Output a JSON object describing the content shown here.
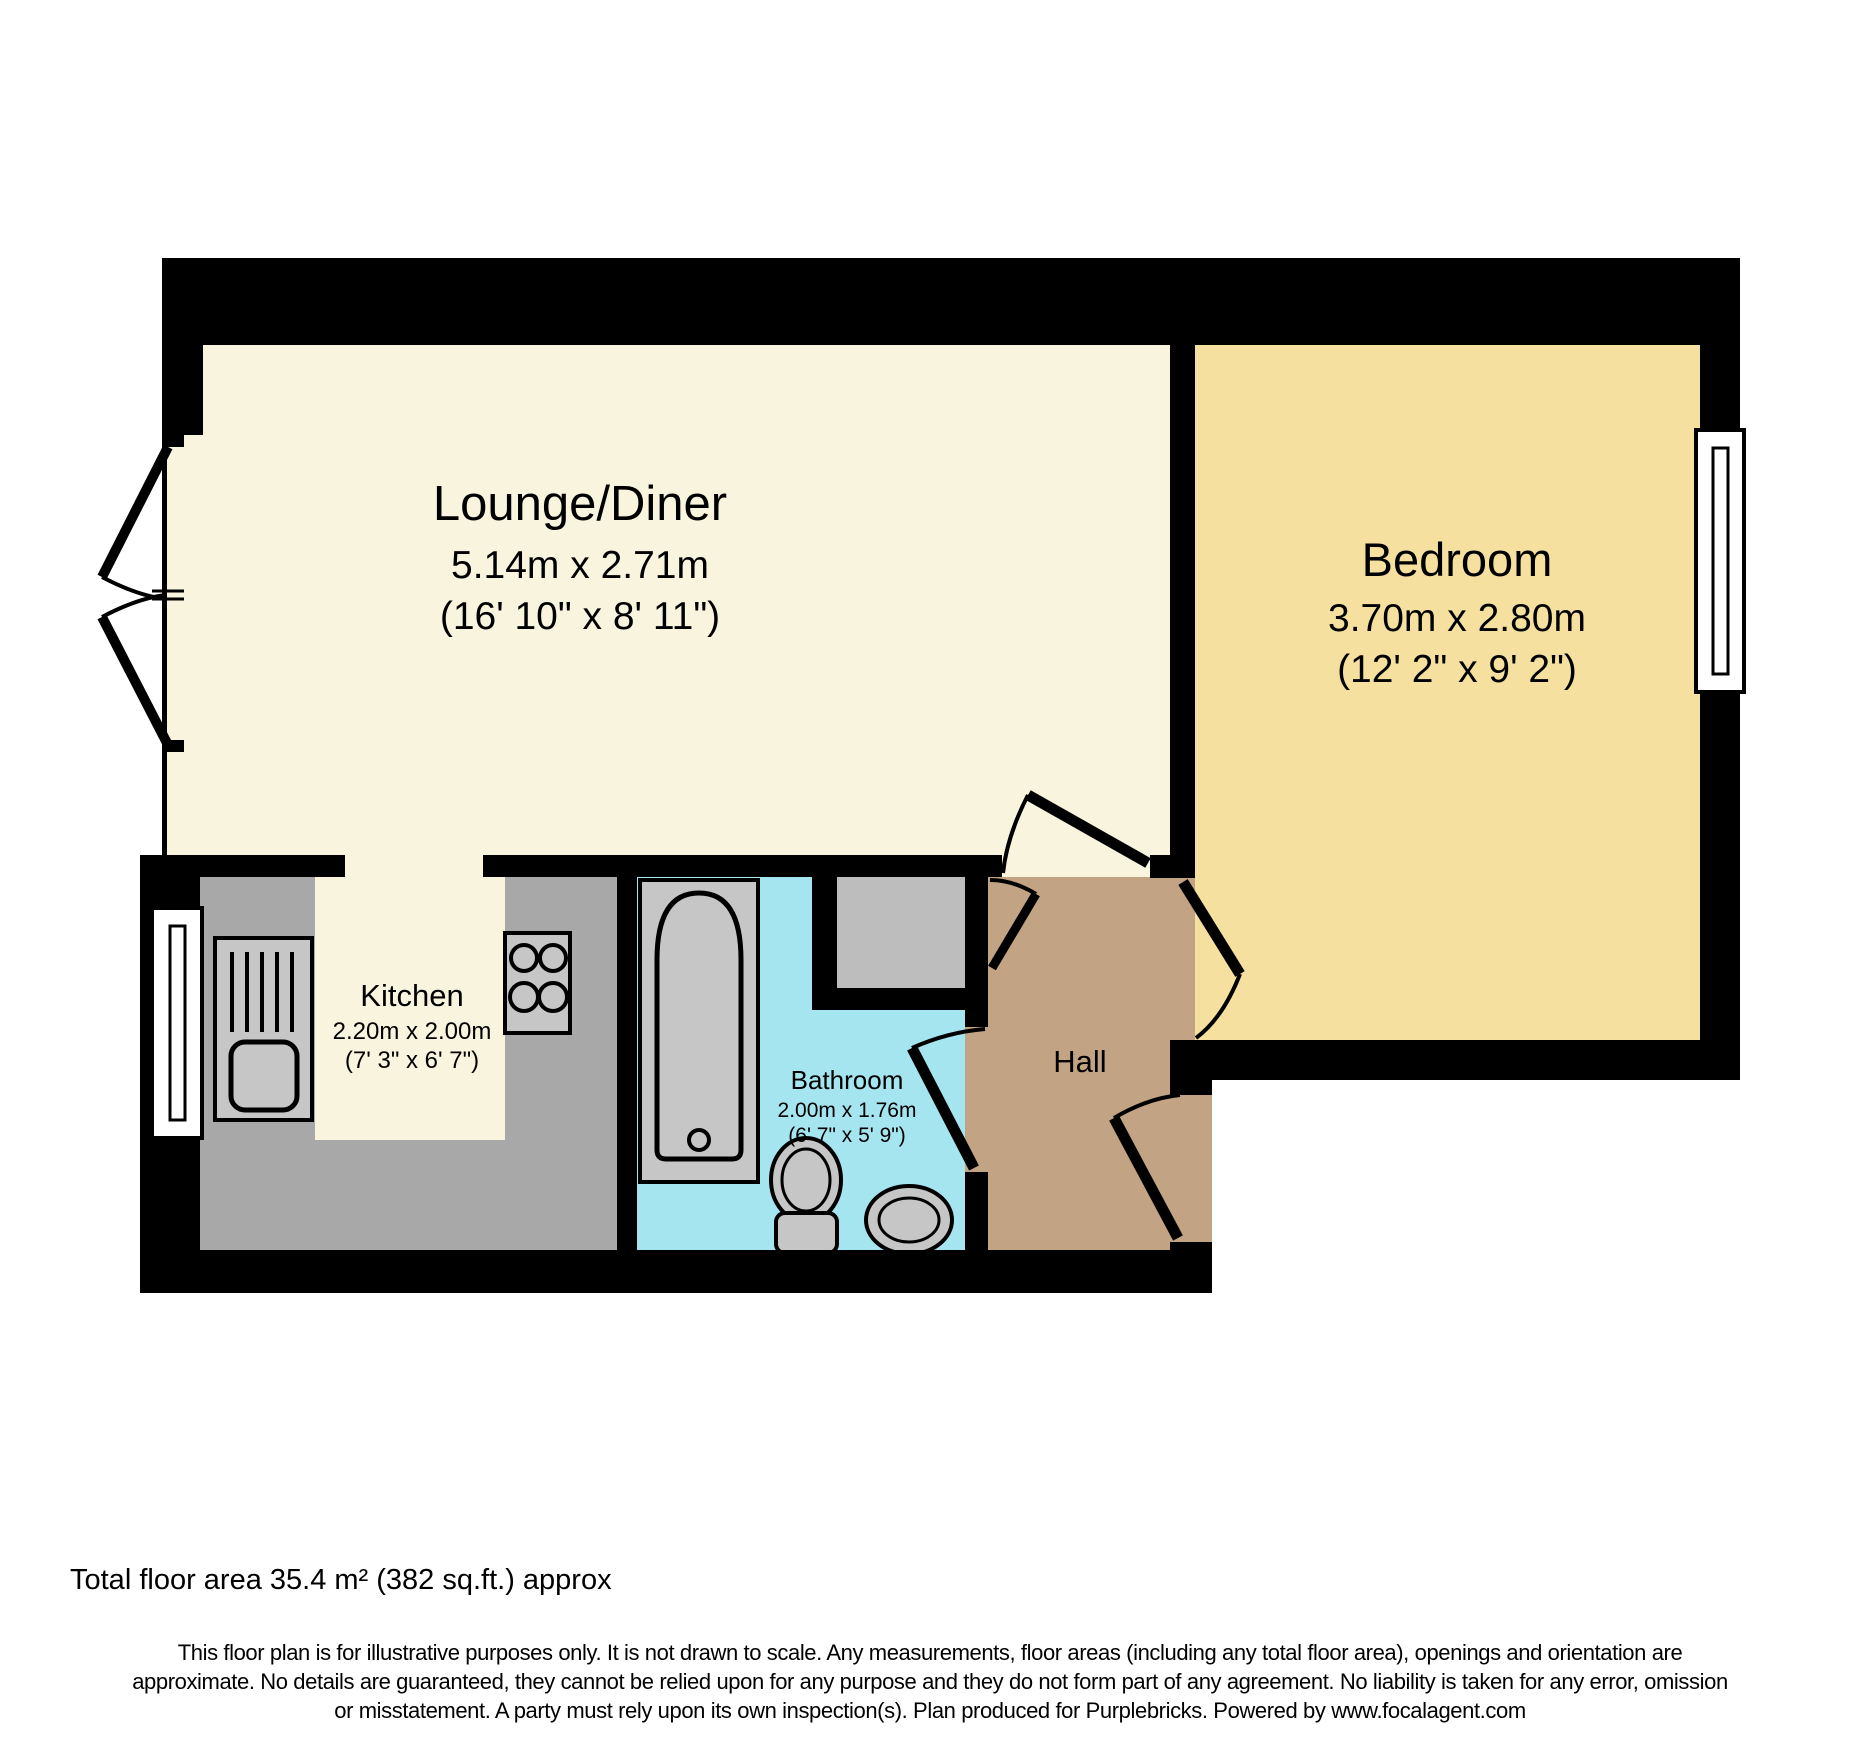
{
  "rooms": {
    "lounge": {
      "name": "Lounge/Diner",
      "metric": "5.14m x 2.71m",
      "imperial": "(16' 10\" x 8' 11\")"
    },
    "bedroom": {
      "name": "Bedroom",
      "metric": "3.70m x 2.80m",
      "imperial": "(12' 2\" x 9' 2\")"
    },
    "kitchen": {
      "name": "Kitchen",
      "metric": "2.20m x 2.00m",
      "imperial": "(7' 3\" x 6' 7\")"
    },
    "bathroom": {
      "name": "Bathroom",
      "metric": "2.00m x 1.76m",
      "imperial": "(6' 7\" x 5' 9\")"
    },
    "hall": {
      "name": "Hall"
    }
  },
  "footer": {
    "total_area": "Total floor area 35.4 m² (382 sq.ft.) approx",
    "disclaimer_line1": "This floor plan is for illustrative purposes only. It is not drawn to scale. Any measurements, floor areas (including any total floor area), openings and orientation are",
    "disclaimer_line2": "approximate. No details are guaranteed, they cannot be relied upon for any purpose and they do not form part of any agreement. No liability is taken for any error, omission",
    "disclaimer_line3": "or misstatement. A party must rely upon its own inspection(s). Plan produced for Purplebricks. Powered by www.focalagent.com"
  },
  "colors": {
    "wall": "#000000",
    "lounge_floor": "#F8F4DE",
    "bedroom_floor": "#F5E0A0",
    "hall_floor": "#C2A383",
    "bathroom_floor": "#A5E5F0",
    "worktop_gray": "#A8A8A8",
    "fixture_gray": "#C6C6C6",
    "cupboard_gray": "#BDBDBD"
  }
}
